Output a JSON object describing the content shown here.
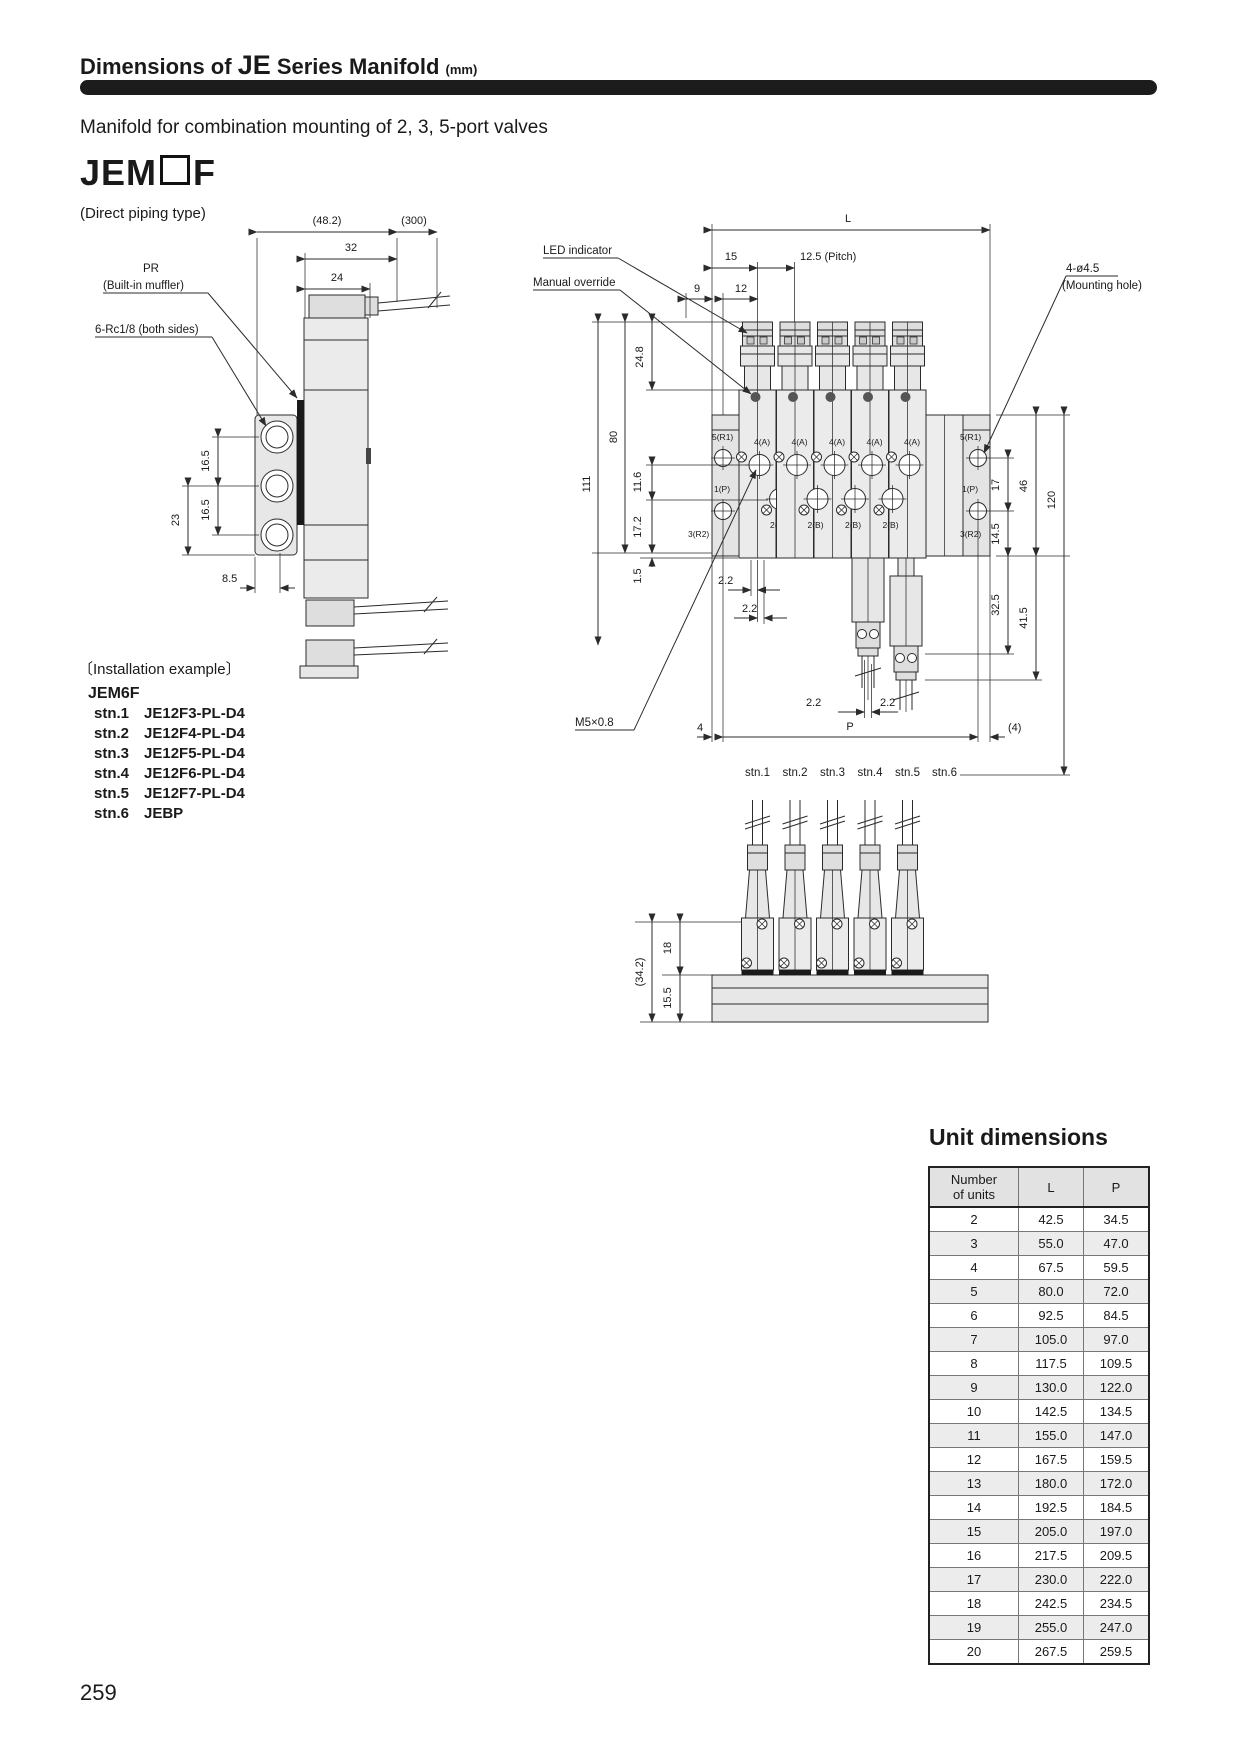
{
  "header": {
    "title_prefix": "Dimensions of ",
    "title_series": "JE",
    "title_rest": " Series Manifold ",
    "title_unit": "(mm)"
  },
  "intro": "Manifold for combination mounting of 2, 3, 5-port valves",
  "model": {
    "prefix": "JEM",
    "suffix": "F",
    "subtitle": "(Direct piping type)"
  },
  "installation": {
    "heading": "〔Installation example〕",
    "model": "JEM6F",
    "rows": [
      {
        "stn": "stn.1",
        "part": "JE12F3-PL-D4"
      },
      {
        "stn": "stn.2",
        "part": "JE12F4-PL-D4"
      },
      {
        "stn": "stn.3",
        "part": "JE12F5-PL-D4"
      },
      {
        "stn": "stn.4",
        "part": "JE12F6-PL-D4"
      },
      {
        "stn": "stn.5",
        "part": "JE12F7-PL-D4"
      },
      {
        "stn": "stn.6",
        "part": "JEBP"
      }
    ]
  },
  "side_view": {
    "pr_label": "PR",
    "pr_note": "(Built-in muffler)",
    "rc_label": "6-Rc1/8 (both sides)",
    "dim_482": "(48.2)",
    "dim_300": "(300)",
    "dim_32": "32",
    "dim_24": "24",
    "dim_165": "16.5",
    "dim_23": "23",
    "dim_85": "8.5"
  },
  "front_view": {
    "led_label": "LED indicator",
    "override_label": "Manual override",
    "mount_label": "4-ø4.5",
    "mount_note": "(Mounting hole)",
    "thread_label": "M5×0.8",
    "dim_L": "L",
    "dim_15": "15",
    "dim_pitch": "12.5 (Pitch)",
    "dim_9": "9",
    "dim_12": "12",
    "dim_248": "24.8",
    "dim_80": "80",
    "dim_111": "111",
    "dim_116": "11.6",
    "dim_172": "17.2",
    "dim_15b": "1.5",
    "dim_22": "2.2",
    "dim_17": "17",
    "dim_46": "46",
    "dim_120": "120",
    "dim_145": "14.5",
    "dim_325": "32.5",
    "dim_415": "41.5",
    "dim_4": "4",
    "dim_P": "P",
    "dim_4p": "(4)",
    "port_r1": "5(R1)",
    "port_a": "4(A)",
    "port_p": "1(P)",
    "port_b": "2(B)",
    "port_r2": "3(R2)",
    "stations": [
      "stn.1",
      "stn.2",
      "stn.3",
      "stn.4",
      "stn.5",
      "stn.6"
    ]
  },
  "bottom_view": {
    "dim_342": "(34.2)",
    "dim_18": "18",
    "dim_155": "15.5"
  },
  "table": {
    "title": "Unit dimensions",
    "col_units_line1": "Number",
    "col_units_line2": "of units",
    "col_L": "L",
    "col_P": "P",
    "rows": [
      [
        "2",
        "42.5",
        "34.5"
      ],
      [
        "3",
        "55.0",
        "47.0"
      ],
      [
        "4",
        "67.5",
        "59.5"
      ],
      [
        "5",
        "80.0",
        "72.0"
      ],
      [
        "6",
        "92.5",
        "84.5"
      ],
      [
        "7",
        "105.0",
        "97.0"
      ],
      [
        "8",
        "117.5",
        "109.5"
      ],
      [
        "9",
        "130.0",
        "122.0"
      ],
      [
        "10",
        "142.5",
        "134.5"
      ],
      [
        "11",
        "155.0",
        "147.0"
      ],
      [
        "12",
        "167.5",
        "159.5"
      ],
      [
        "13",
        "180.0",
        "172.0"
      ],
      [
        "14",
        "192.5",
        "184.5"
      ],
      [
        "15",
        "205.0",
        "197.0"
      ],
      [
        "16",
        "217.5",
        "209.5"
      ],
      [
        "17",
        "230.0",
        "222.0"
      ],
      [
        "18",
        "242.5",
        "234.5"
      ],
      [
        "19",
        "255.0",
        "247.0"
      ],
      [
        "20",
        "267.5",
        "259.5"
      ]
    ]
  },
  "page_number": "259"
}
